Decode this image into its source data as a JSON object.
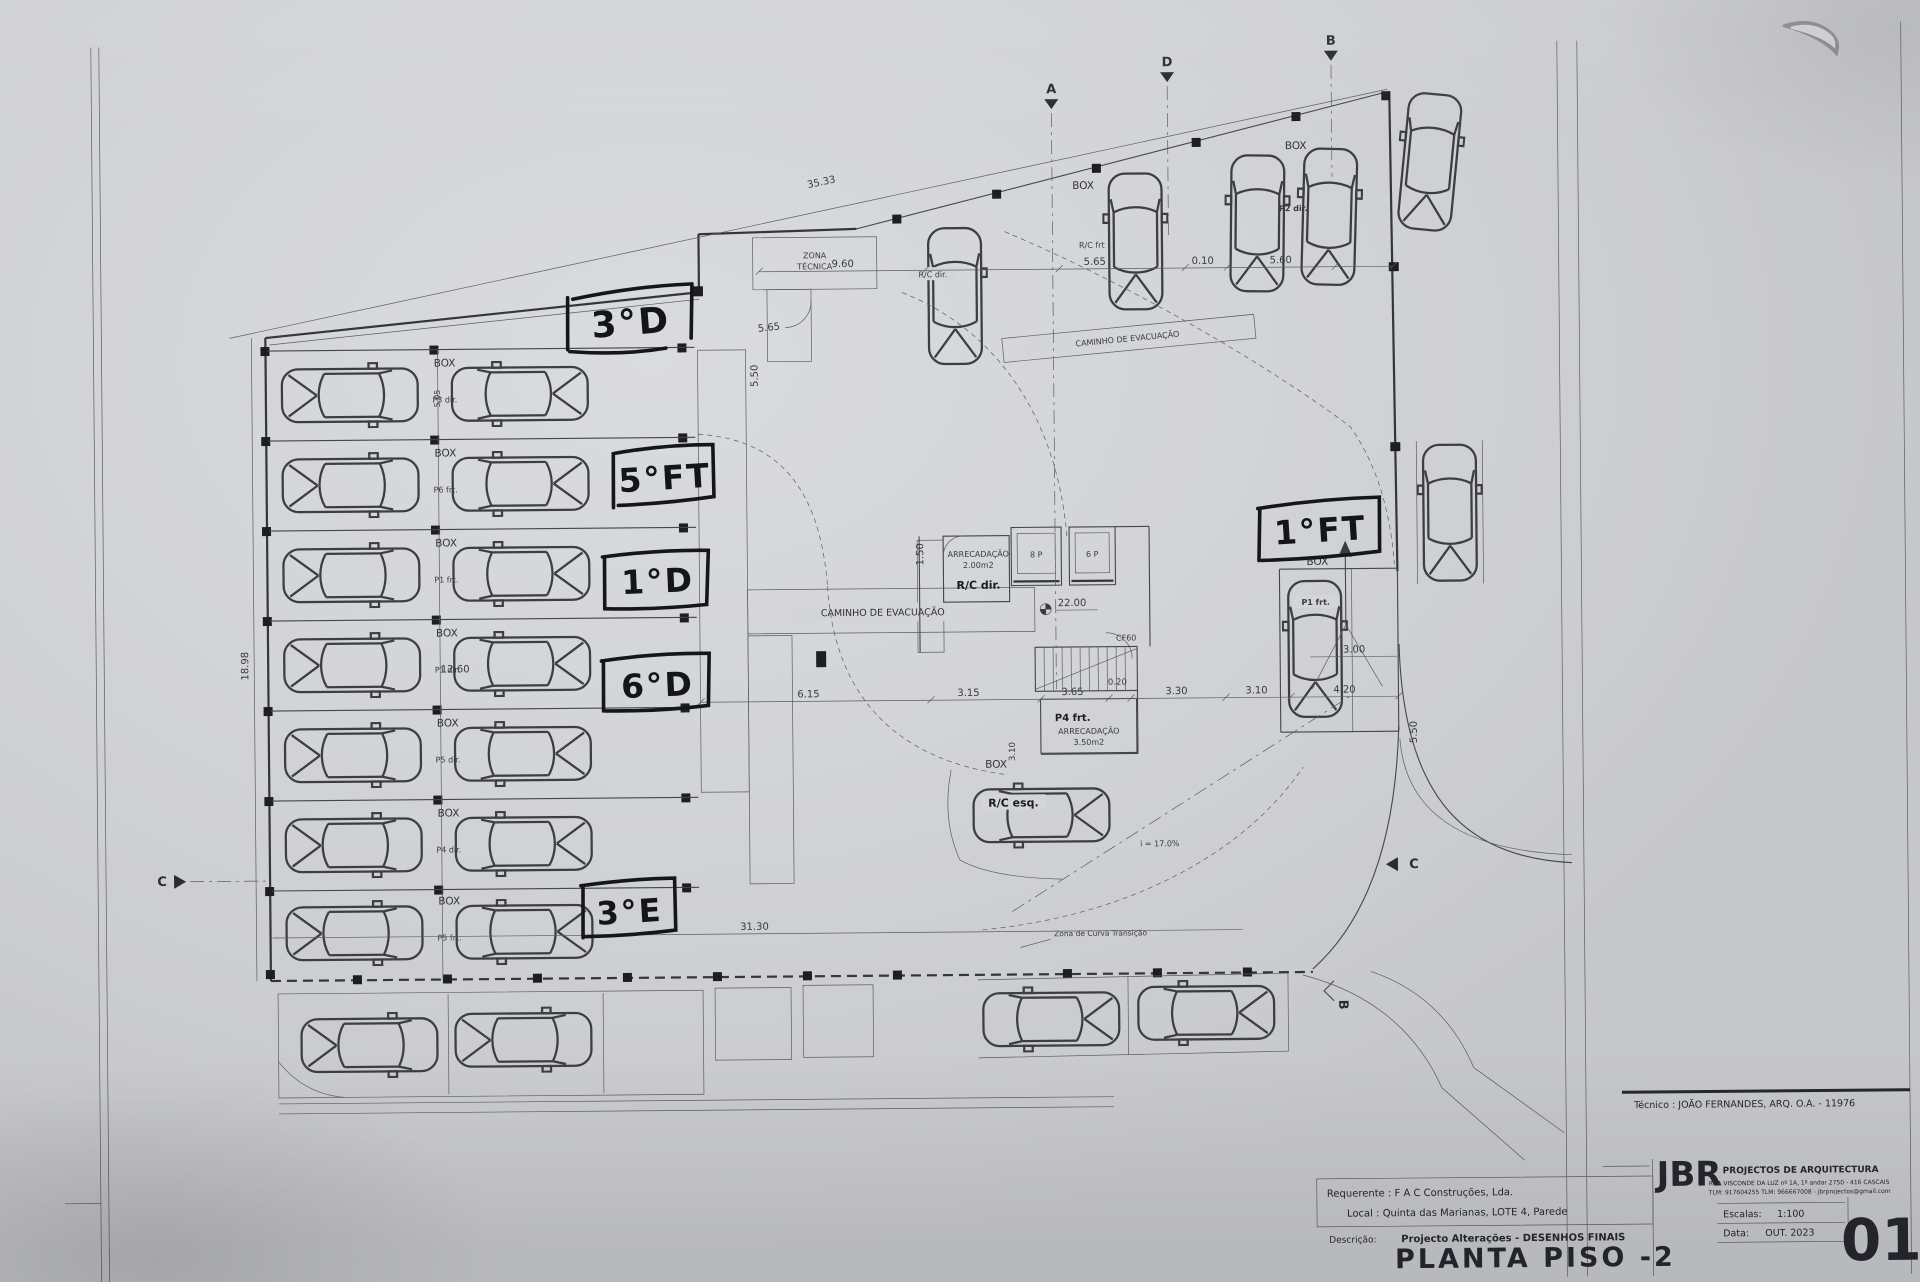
{
  "sheet": {
    "number": "01",
    "title": "PLANTA PISO -2",
    "tecnico": "Técnico : JOÃO FERNANDES, ARQ.   O.A. - 11976",
    "requerente": "Requerente : F A C  Construções, Lda.",
    "local": "Local : Quinta das Marianas, LOTE 4, Parede",
    "descricao_label": "Descrição:",
    "descricao": "Projecto Alterações - DESENHOS FINAIS",
    "escalas_label": "Escalas:",
    "escalas": "1:100",
    "data_label": "Data:",
    "data": "OUT. 2023",
    "firm": {
      "initials": "JBR",
      "name": "PROJECTOS DE ARQUITECTURA",
      "address": "RUA VISCONDE DA LUZ nº 1A, 1º andar  2750 - 416  CASCAIS",
      "contacts": "TLM: 917604255  TLM: 966667008  -  jbrprojectos@gmail.com"
    }
  },
  "annotations": {
    "a_3d": "3°D",
    "a_5ft": "5°FT",
    "a_1d": "1°D",
    "a_6d": "6°D",
    "a_3e": "3°E",
    "a_1ft": "1°FT"
  },
  "labels": {
    "zona_tecnica_1": "ZONA",
    "zona_tecnica_2": "TÉCNICA",
    "caminho": "CAMINHO  DE  EVACUAÇÃO",
    "box": "BOX",
    "rc_frt": "R/C frt",
    "rc_dir": "R/C dir.",
    "rc_esq": "R/C esq.",
    "p2_dir": "P2 dir.",
    "p1_frt": "P1 frt.",
    "p4_frt": "P4 frt.",
    "arrecadacao": "ARRECADAÇÃO",
    "area_200": "2.00m2",
    "area_350": "3.50m2",
    "lift8": "8 P",
    "lift6": "6 P",
    "cf60": "CF60",
    "level": "22.00",
    "slope": "i = 17.0%",
    "curva": "Zona  de  Curva  Transição",
    "stall_rows": [
      "P3 dir.",
      "P6 frt.",
      "P1 frt.",
      "P1 dir.",
      "P5 dir.",
      "P4 dir.",
      "P5 frt."
    ]
  },
  "dims": {
    "d3533": "35.33",
    "d960": "9.60",
    "d565a": "5.65",
    "d010": "0.10",
    "d560": "5.60",
    "d565b": "5.65",
    "d1898": "18.98",
    "d1260": "12.60",
    "d505": "5.05",
    "d3130": "31.30",
    "d615": "6.15",
    "d315": "3.15",
    "d365": "3.65",
    "d020": "0.20",
    "d330": "3.30",
    "d310": "3.10",
    "d420": "4.20",
    "d300": "3.00",
    "d550a": "5.50",
    "d550b": "5.50",
    "d150": "1.50",
    "d310v": "3.10"
  },
  "markers": {
    "a": "A",
    "d": "D",
    "b_top": "B",
    "c_left": "C",
    "c_right": "C",
    "b_bottom": "B"
  }
}
